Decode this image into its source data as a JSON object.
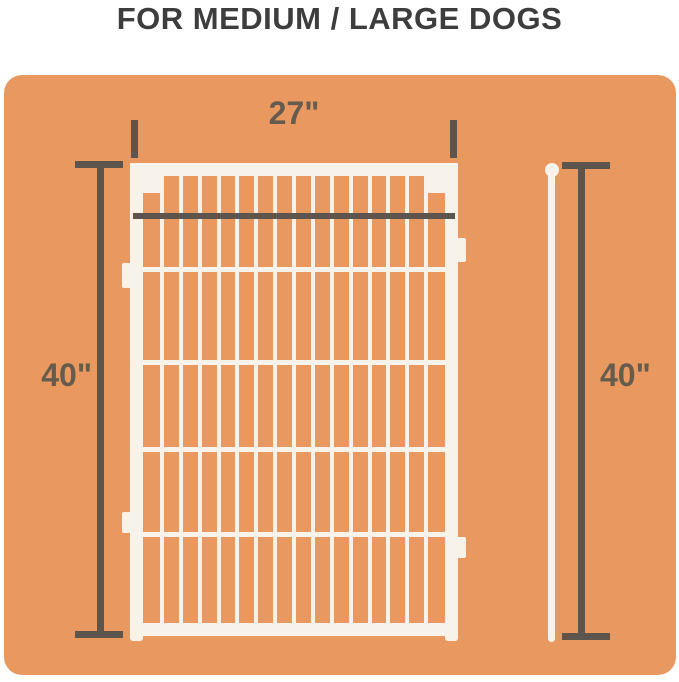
{
  "title": "FOR MEDIUM / LARGE DOGS",
  "dimensions": {
    "width": "27\"",
    "height_left": "40\"",
    "height_right": "40\""
  },
  "fence": {
    "vertical_bars": 15,
    "horizontal_rails": 4,
    "connector_tabs": 4
  },
  "colors": {
    "panel_background": "#E9995F",
    "dimension_lines": "#5C554D",
    "dimension_labels": "#665C4E",
    "fence": "#F7F3EA",
    "title_text": "#3D3D3D",
    "page_background": "#FFFFFF"
  }
}
